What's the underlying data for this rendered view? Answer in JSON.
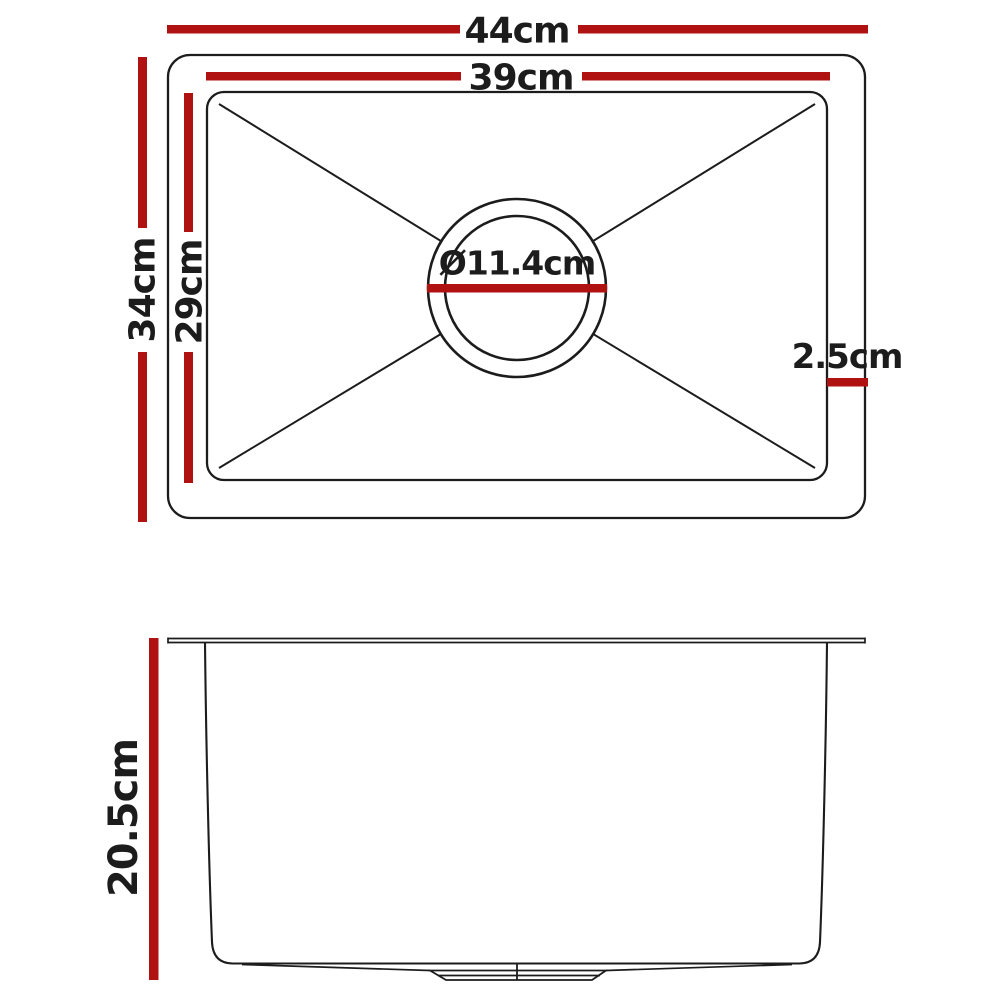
{
  "title": "Kitchen sink dimension diagram",
  "colors": {
    "dimension_red": "#b01212",
    "line": "#1c1c1c",
    "background": "#ffffff"
  },
  "top_view": {
    "description": "top view of sink with centre drain",
    "outer_width": {
      "label": "44cm"
    },
    "inner_width": {
      "label": "39cm"
    },
    "outer_height": {
      "label": "34cm"
    },
    "inner_height": {
      "label": "29cm"
    },
    "drain_diameter": {
      "label": "Ø11.4cm"
    },
    "rim_width": {
      "label": "2.5cm"
    }
  },
  "side_view": {
    "description": "side elevation of sink bowl with drain",
    "depth": {
      "label": "20.5cm"
    }
  }
}
